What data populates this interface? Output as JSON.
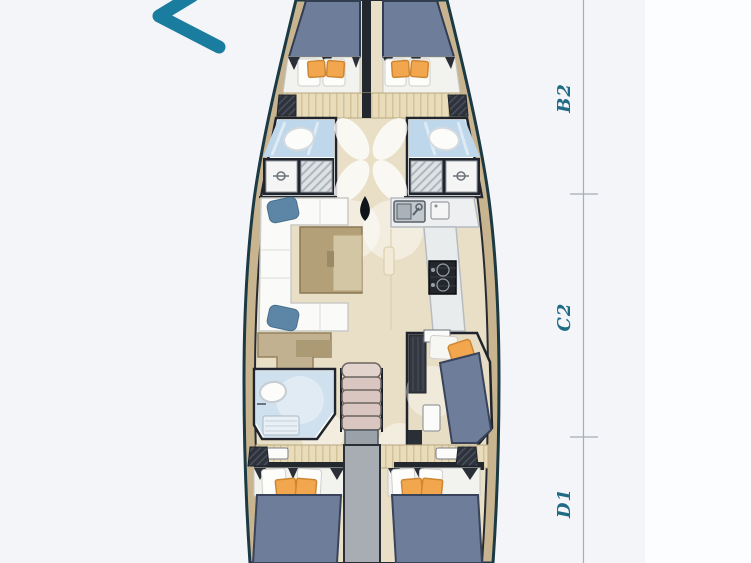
{
  "diagram": {
    "type": "yacht-floor-plan",
    "logo": {
      "glyph": "chevron-left"
    },
    "ruler": {
      "labels": [
        {
          "text": "B2"
        },
        {
          "text": "C2"
        },
        {
          "text": "D1"
        }
      ]
    },
    "areas": [
      "forward-cabin-port",
      "forward-cabin-starboard",
      "forward-bathroom-port",
      "forward-bathroom-starboard",
      "salon-sofa",
      "salon-table",
      "galley",
      "mast",
      "nav-station",
      "aft-bathroom",
      "companionway-stairs",
      "mid-cabin-starboard",
      "aft-cabin-port",
      "aft-cabin-starboard",
      "engine-corridor"
    ],
    "colors": {
      "background": "#f3f5f8",
      "background_right": "#fcfdfe",
      "label_teal": "#1f6a85",
      "logo_teal": "#1a7c9e",
      "hull_outline": "#1c3a44",
      "deck_tan": "#c8b48f",
      "floor_wood": "#e9dfc6",
      "mattress_blue": "#6e7e9a",
      "cushion_orange": "#f2a74e",
      "bathroom_blue": "#bed7ea",
      "corridor_gray": "#a8adb3",
      "stairs_pink": "#d9c6c0"
    }
  }
}
